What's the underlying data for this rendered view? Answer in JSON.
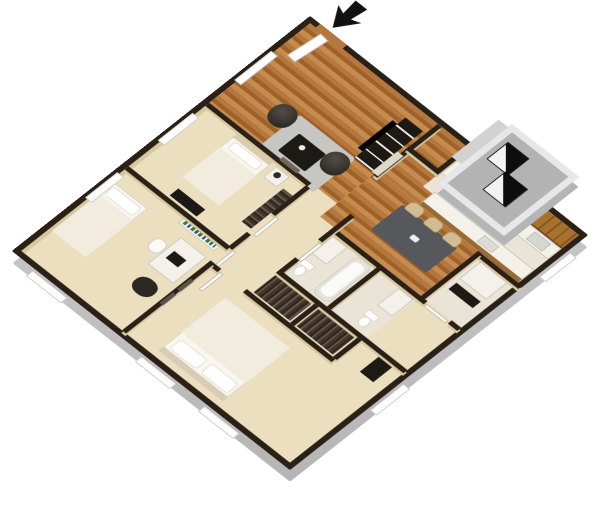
{
  "title": "3D apartment floor plan render",
  "view": {
    "projection": "isometric-3d",
    "background": "white",
    "visible_text": "none"
  },
  "palette": {
    "background": "#ffffff",
    "wall_top": "#2a2016",
    "wall_face": "#d8c8a0",
    "floor_carpet": "#ecdfbf",
    "floor_wood": "#b5773d",
    "floor_wood_dark": "#9e6128",
    "floor_wood_light": "#c68c4f",
    "floor_tile": "#e9e4d6",
    "exterior_band": "#d2d2d2",
    "exterior_band_dark": "#b5b5b5",
    "cabinet_wood": "#a9712e",
    "cabinet_wood_dark": "#86561f",
    "counter_white": "#f3f1e9",
    "appliance_dark": "#30302e",
    "furniture_dark": "#1d1914",
    "table_gray": "#56585b",
    "chair_tan": "#d2bc92",
    "rug_gray": "#c6c6c2",
    "bed_white": "#f8f6ef",
    "bed_blanket": "#f1ecdd",
    "pillow_white": "#ffffff",
    "window_white": "#fdfdfd",
    "patio_floor": "#b3b3b3",
    "patio_rim": "#e7e7e7",
    "books_green": "#3e7a3e",
    "arrow_black": "#111111"
  },
  "scene": {
    "entry": {
      "marker": "entry-arrow",
      "door": "open-white-door"
    },
    "rooms": [
      {
        "id": "living-room",
        "floor": "wood",
        "furniture": [
          "tv-console",
          "tv",
          "bean-chair",
          "bean-chair",
          "coffee-table",
          "rug",
          "window"
        ]
      },
      {
        "id": "kitchen",
        "floor": "tile",
        "furniture": [
          "upper-cabinets",
          "counter",
          "stove",
          "sink",
          "fridge",
          "peninsula-counter"
        ]
      },
      {
        "id": "dining-area",
        "floor": "wood",
        "furniture": [
          "dining-table",
          "chair",
          "chair",
          "chair"
        ]
      },
      {
        "id": "laundry-closet",
        "floor": "tile",
        "furniture": [
          "appliance",
          "shelf"
        ]
      },
      {
        "id": "bedroom-1",
        "floor": "carpet",
        "furniture": [
          "bed",
          "nightstand",
          "lamp",
          "dresser",
          "closet-clothes",
          "window",
          "picture-frame"
        ]
      },
      {
        "id": "bedroom-2",
        "floor": "carpet",
        "furniture": [
          "bed",
          "desk",
          "desk-chair",
          "laptop",
          "bookshelf",
          "lounge-chair",
          "window"
        ]
      },
      {
        "id": "master-bedroom",
        "floor": "carpet",
        "furniture": [
          "double-bed",
          "pillows",
          "closet-clothes",
          "closet-clothes",
          "picture-frames",
          "windows"
        ]
      },
      {
        "id": "bathroom-1",
        "floor": "tile",
        "furniture": [
          "bathtub",
          "vanity",
          "toilet"
        ]
      },
      {
        "id": "bathroom-2",
        "floor": "tile",
        "furniture": [
          "vanity",
          "toilet"
        ]
      },
      {
        "id": "hallway",
        "floor": "carpet",
        "furniture": [
          "doors"
        ]
      },
      {
        "id": "patio-balcony",
        "floor": "concrete",
        "furniture": [
          "patio-unit",
          "patio-unit"
        ]
      }
    ]
  }
}
